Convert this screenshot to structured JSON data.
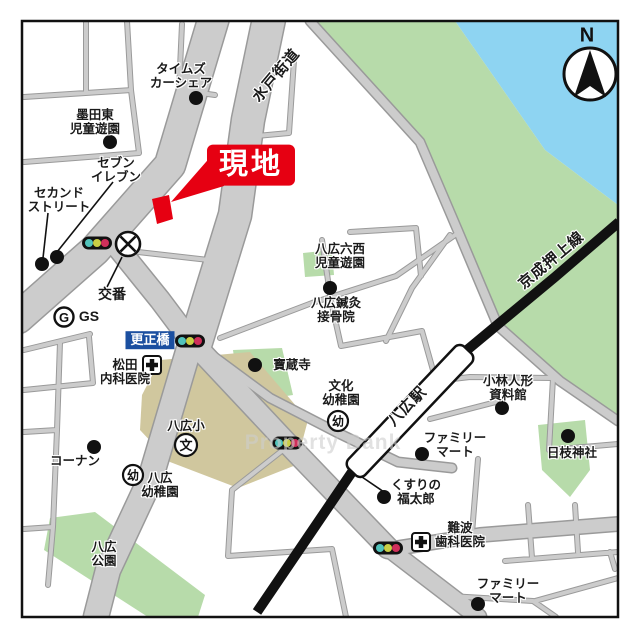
{
  "labels": {
    "times": "タイムズ\nカーシェア",
    "sumida_park": "墨田東\n児童遊園",
    "seven": "セブン\nイレブン",
    "second_street": "セカンド\nストリート",
    "genchi": "現地",
    "mito_kaido": "水戸街道",
    "koban": "交番",
    "gs": "GS",
    "gs_symbol": "G",
    "kosei_bridge": "更正橋",
    "matsuda": "松田\n内科医院",
    "hozoji": "寶蔵寺",
    "rokunishi_park": "八広六西\n児童遊園",
    "shinkyu": "八広鍼灸\n接骨院",
    "keisei_line": "京成押上線",
    "north": "N",
    "yahiro_elem": "八広小",
    "school_symbol": "文",
    "kinder_symbol": "幼",
    "yahiro_kinder": "八広\n幼稚園",
    "konan": "コーナン",
    "yahiro_park": "八広\n公園",
    "bunka_kinder": "文化\n幼稚園",
    "station": "八広駅",
    "famima_center": "ファミリー\nマート",
    "kobayashi": "小林人形\n資料館",
    "hie_shrine": "日枝神社",
    "fukutaro": "くすりの\n福太郎",
    "namba": "難波\n歯科医院",
    "famima_south": "ファミリー\nマート",
    "watermark": "Property Bank"
  },
  "colors": {
    "site_red": "#e60012",
    "bridge_label_blue": "#1b4fa0",
    "road_gray": "#cccccc",
    "road_casing": "#9a9a9a",
    "green_area": "#b7dbaa",
    "water_blue": "#8ed4f2",
    "schoolground_tan": "#d0c79e",
    "railway_black": "#111111",
    "signal_teal": "#52c3bb",
    "signal_yellow": "#c9cf45",
    "signal_red": "#cf2f5a"
  }
}
